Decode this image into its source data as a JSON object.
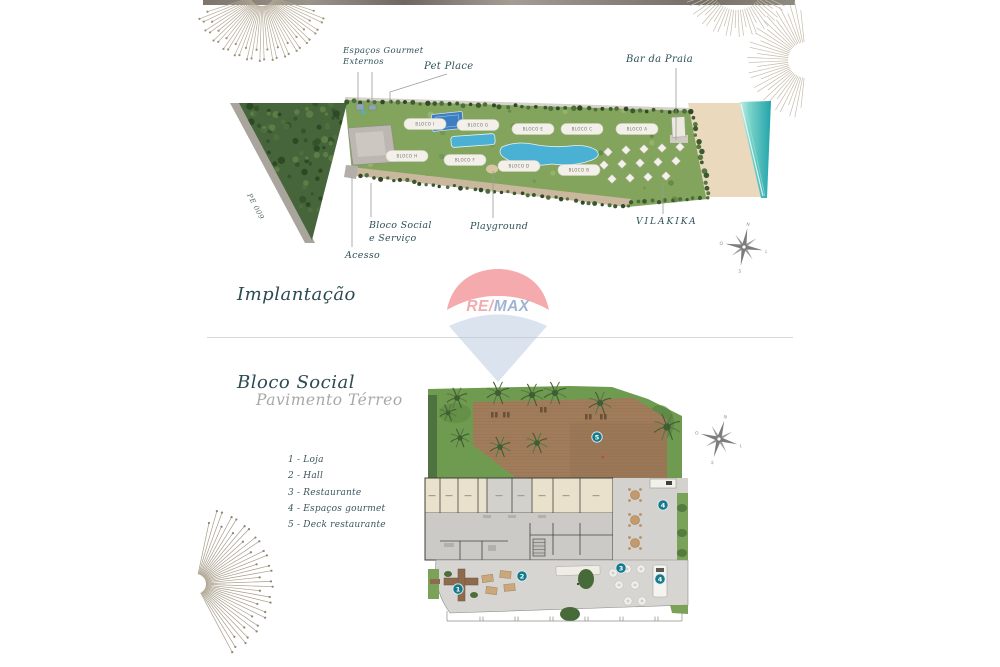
{
  "masterplan": {
    "title": "Implantação",
    "road_label": "PE 009",
    "blocks": [
      "BLOCO I",
      "BLOCO G",
      "BLOCO E",
      "BLOCO C",
      "BLOCO A",
      "BLOCO H",
      "BLOCO F",
      "BLOCO D",
      "BLOCO B"
    ],
    "callouts": {
      "espacos_gourmet_line1": "Espaços Gourmet",
      "espacos_gourmet_line2": "Externos",
      "pet_place": "Pet Place",
      "bar_da_praia": "Bar da Praia",
      "bloco_social_line1": "Bloco Social",
      "bloco_social_line2": "e Serviço",
      "playground": "Playground",
      "vilakika": "VILAKIKA",
      "acesso": "Acesso"
    }
  },
  "compass": {
    "n": "N",
    "e": "L",
    "s": "S",
    "w": "O"
  },
  "floorplan": {
    "title": "Bloco Social",
    "subtitle": "Pavimento Térreo",
    "legend": [
      "1 - Loja",
      "2 - Hall",
      "3 - Restaurante",
      "4 - Espaços gourmet",
      "5 - Deck restaurante"
    ],
    "badges": {
      "b1": "1",
      "b2": "2",
      "b3": "3",
      "b4": "4",
      "b5": "5"
    }
  },
  "watermark": {
    "re": "RE",
    "slash": "/",
    "max": "MAX"
  },
  "colors": {
    "accent_teal": "#16798c",
    "text_dark": "#2e5059",
    "text_muted": "#a6aaa5",
    "remax_red": "#e23a3f",
    "remax_blue": "#1d4f9c",
    "sea": "#22a3ab",
    "sand": "#ead9bd",
    "lawn": "#83a45c",
    "deck": "#a17c5b"
  }
}
